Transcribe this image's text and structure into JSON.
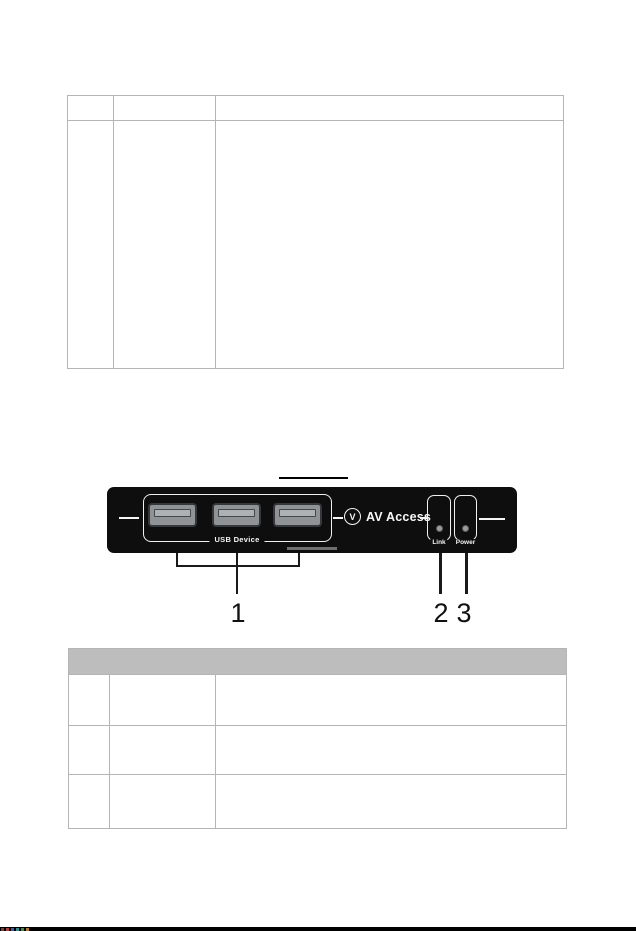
{
  "document": {
    "top_table": {
      "rows": [
        {
          "cells": [
            "",
            "",
            ""
          ]
        },
        {
          "cells": [
            "",
            "",
            ""
          ]
        }
      ]
    },
    "figure": {
      "panel": {
        "usb_label": "USB Device",
        "brand": "AV Access",
        "logo_glyph": "V",
        "link_label": "Link",
        "power_label": "Power"
      },
      "callouts": [
        {
          "label": "1"
        },
        {
          "label": "2"
        },
        {
          "label": "3"
        }
      ]
    },
    "bottom_table": {
      "header": "",
      "rows": [
        {
          "cells": [
            "",
            "",
            ""
          ]
        },
        {
          "cells": [
            "",
            "",
            ""
          ]
        },
        {
          "cells": [
            "",
            "",
            ""
          ]
        }
      ]
    },
    "colors": {
      "panel_black": "#0e0e0e",
      "table_border_gray": "#b5b5b5",
      "table_header_gray": "#bdbdbd",
      "usb_port_gray": "#8f9396",
      "led_gray": "#9c9c9c"
    }
  }
}
